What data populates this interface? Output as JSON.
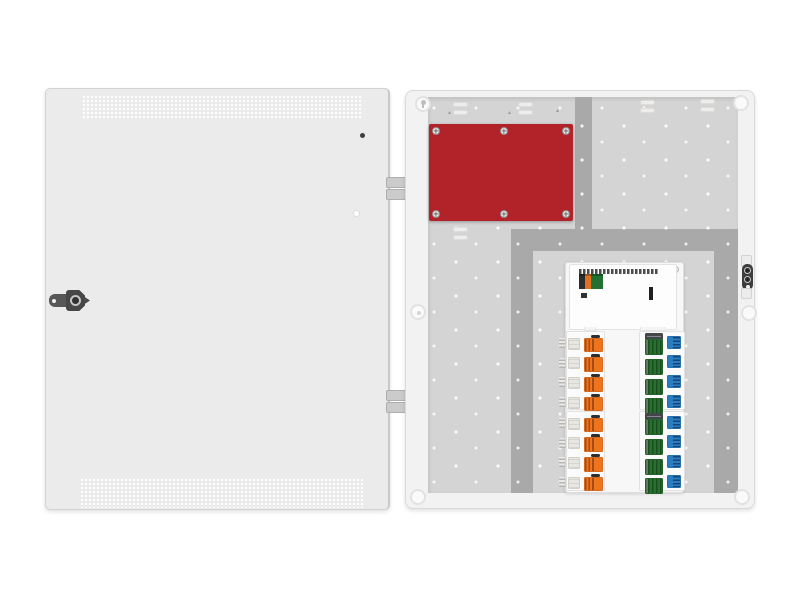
{
  "illustration": {
    "name": "open-electrical-enclosure-with-door-and-breaker-modules",
    "palette": {
      "door": "#ebebeb",
      "frame": "#f2f2f2",
      "panel": "#d4d4d4",
      "rail": "#a9a9a9",
      "red": "#b12328",
      "metal_dark": "#4a4a4a"
    },
    "door": {
      "vent_bands": 2,
      "lock": "cam-lock-handle",
      "hinges": 2
    },
    "cover_plate": {
      "color": "#b12328",
      "screws": 6
    },
    "controller": {
      "terminal_blocks": [
        {
          "name": "terminal-block-maroon",
          "color": "#8d1912",
          "width": 15
        },
        {
          "name": "terminal-block-yellow",
          "color": "#f0c207",
          "width": 13
        },
        {
          "name": "terminal-block-gray",
          "color": "#e4e3db",
          "width": 10
        },
        {
          "name": "terminal-block-green",
          "color": "#217231",
          "width": 24
        },
        {
          "name": "terminal-block-orange",
          "color": "#e2711d",
          "width": 12
        },
        {
          "name": "terminal-block-black",
          "color": "#2c2c2c",
          "width": 6
        }
      ]
    },
    "breakers": {
      "groups": [
        {
          "top": 334
        },
        {
          "top": 414
        }
      ],
      "rows_per_group": 4,
      "pitch": 19.7,
      "columns": [
        {
          "name": "orange-breaker",
          "color": "#ee7520"
        },
        {
          "name": "green-terminal",
          "color": "#27702f"
        },
        {
          "name": "blue-terminal",
          "color": "#2b7dc1"
        }
      ]
    }
  }
}
